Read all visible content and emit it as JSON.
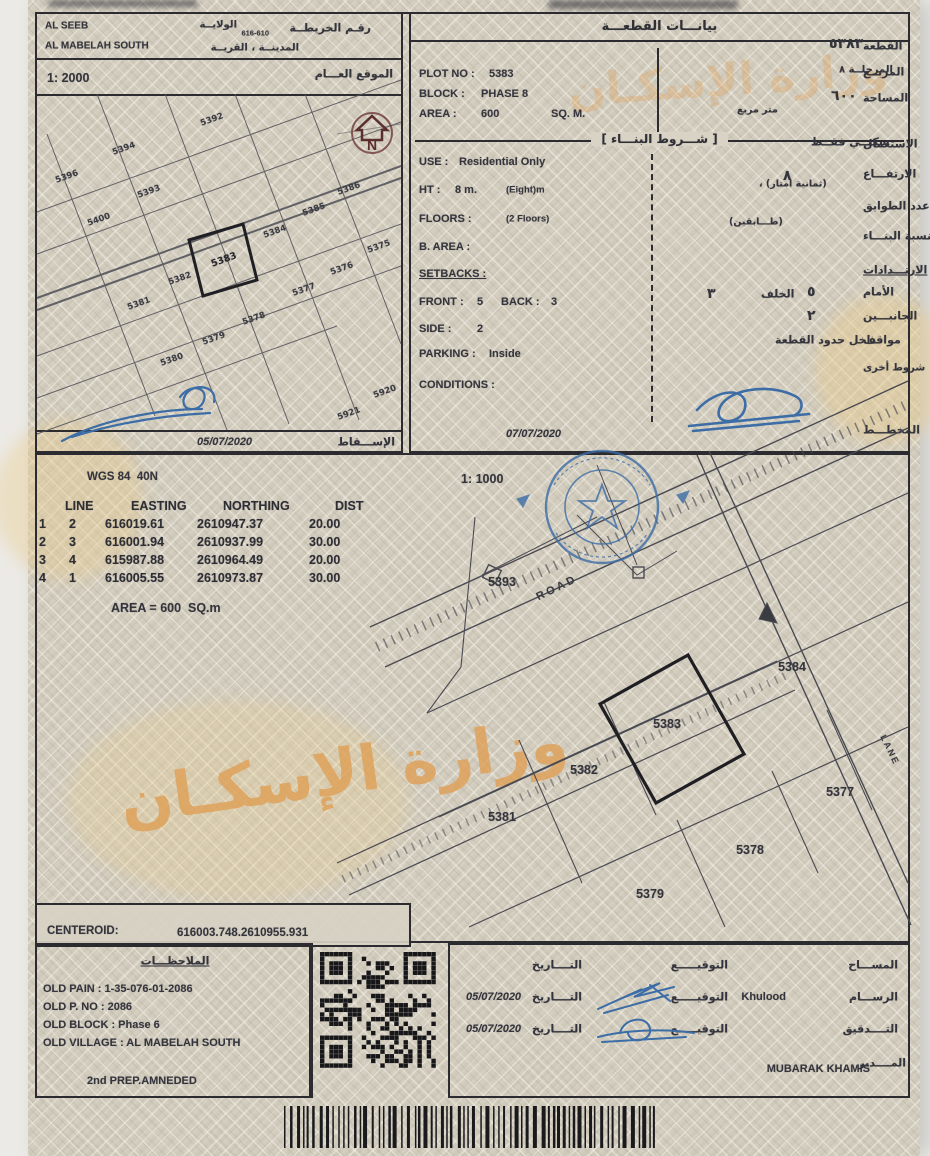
{
  "doc": {
    "top_left": {
      "scale": "1: 2000",
      "date": "05/07/2020",
      "north": "N",
      "header_items": [
        {
          "t": "AL SEEB",
          "x": 8,
          "y": 12,
          "c": "en s10"
        },
        {
          "t": "AL MABELAH SOUTH",
          "x": 8,
          "y": 32,
          "c": "en s10"
        },
        {
          "t": "رقـم الخريطــة",
          "x": 334,
          "y": 14,
          "a": "r"
        },
        {
          "t": "616-610",
          "x": 232,
          "y": 19,
          "a": "r",
          "c": "en tiny"
        },
        {
          "t": "الولايــة",
          "x": 200,
          "y": 11,
          "a": "r",
          "c": "sm2"
        },
        {
          "t": "المدينــة ، القريــة",
          "x": 262,
          "y": 34,
          "a": "r",
          "c": "sm2"
        },
        {
          "t": "1: 2000",
          "x": 10,
          "y": 64,
          "c": "en s12"
        },
        {
          "t": "الموقع العـــام",
          "x": 356,
          "y": 60,
          "a": "r"
        },
        {
          "t": "05/07/2020",
          "x": 160,
          "y": 428,
          "c": "en s11i"
        },
        {
          "t": "الإســـقاط",
          "x": 358,
          "y": 428,
          "a": "r"
        }
      ],
      "plots": [
        {
          "t": "5392",
          "x": 175,
          "y": 26
        },
        {
          "t": "5394",
          "x": 87,
          "y": 55
        },
        {
          "t": "5396",
          "x": 30,
          "y": 83
        },
        {
          "t": "5393",
          "x": 112,
          "y": 98
        },
        {
          "t": "5400",
          "x": 62,
          "y": 126
        },
        {
          "t": "5386",
          "x": 312,
          "y": 95
        },
        {
          "t": "5385",
          "x": 277,
          "y": 116
        },
        {
          "t": "5384",
          "x": 238,
          "y": 138
        },
        {
          "t": "5375",
          "x": 342,
          "y": 153
        },
        {
          "t": "5376",
          "x": 305,
          "y": 175
        },
        {
          "t": "5383",
          "x": 187,
          "y": 166,
          "c": "map mb"
        },
        {
          "t": "5382",
          "x": 143,
          "y": 185
        },
        {
          "t": "5377",
          "x": 267,
          "y": 196
        },
        {
          "t": "5381",
          "x": 102,
          "y": 210
        },
        {
          "t": "5378",
          "x": 217,
          "y": 225
        },
        {
          "t": "5379",
          "x": 177,
          "y": 245
        },
        {
          "t": "5380",
          "x": 135,
          "y": 266
        },
        {
          "t": "5920",
          "x": 348,
          "y": 298
        },
        {
          "t": "5921",
          "x": 312,
          "y": 320
        }
      ]
    },
    "plot_panel": {
      "title_ar": "بيانـــات القطعـــة",
      "conditions_header_ar": "[ شـــروط البنـــاء ]",
      "date": "07/07/2020",
      "en": [
        {
          "t": "PLOT NO :",
          "x": 8,
          "y": 60
        },
        {
          "t": "5383",
          "x": 78,
          "y": 60
        },
        {
          "t": "BLOCK :",
          "x": 8,
          "y": 80
        },
        {
          "t": "PHASE 8",
          "x": 70,
          "y": 80
        },
        {
          "t": "AREA :",
          "x": 8,
          "y": 100
        },
        {
          "t": "600",
          "x": 70,
          "y": 100
        },
        {
          "t": "SQ. M.",
          "x": 140,
          "y": 100
        },
        {
          "t": "USE :",
          "x": 8,
          "y": 148
        },
        {
          "t": "Residential Only",
          "x": 48,
          "y": 148
        },
        {
          "t": "HT :",
          "x": 8,
          "y": 176
        },
        {
          "t": "8 m.",
          "x": 44,
          "y": 176
        },
        {
          "t": "(Eight)m",
          "x": 95,
          "y": 176,
          "c": "en sm"
        },
        {
          "t": "FLOORS :",
          "x": 8,
          "y": 205
        },
        {
          "t": "(2 Floors)",
          "x": 95,
          "y": 205,
          "c": "en sm"
        },
        {
          "t": "B. AREA :",
          "x": 8,
          "y": 233
        },
        {
          "t": "SETBACKS :",
          "x": 8,
          "y": 260,
          "c": "en und"
        },
        {
          "t": "FRONT :",
          "x": 8,
          "y": 288
        },
        {
          "t": "5",
          "x": 66,
          "y": 288
        },
        {
          "t": "BACK :",
          "x": 90,
          "y": 288
        },
        {
          "t": "3",
          "x": 140,
          "y": 288
        },
        {
          "t": "SIDE :",
          "x": 8,
          "y": 315
        },
        {
          "t": "2",
          "x": 66,
          "y": 315
        },
        {
          "t": "PARKING :",
          "x": 8,
          "y": 340
        },
        {
          "t": "Inside",
          "x": 78,
          "y": 340
        },
        {
          "t": "CONDITIONS :",
          "x": 8,
          "y": 371
        },
        {
          "t": "07/07/2020",
          "x": 95,
          "y": 420,
          "c": "en s11i"
        }
      ],
      "ar": [
        {
          "t": "القطعة",
          "x": 452,
          "y": 32
        },
        {
          "t": "٥٣٨٣",
          "x": 418,
          "y": 30,
          "c": "big"
        },
        {
          "t": "المربــع",
          "x": 452,
          "y": 58
        },
        {
          "t": "المرحلــة ٨",
          "x": 428,
          "y": 56,
          "c": "sm2"
        },
        {
          "t": "المساحة",
          "x": 452,
          "y": 84
        },
        {
          "t": "٦٠٠",
          "x": 420,
          "y": 82,
          "c": "big"
        },
        {
          "t": "متر مربع",
          "x": 326,
          "y": 96,
          "c": "sm"
        },
        {
          "t": "الاستعمال",
          "x": 452,
          "y": 130
        },
        {
          "t": "سكنــي فقــط",
          "x": 400,
          "y": 128
        },
        {
          "t": "الارتفـــاع",
          "x": 452,
          "y": 160
        },
        {
          "t": "٨",
          "x": 372,
          "y": 162,
          "c": "big"
        },
        {
          "t": "، (ثمانية امتار)",
          "x": 348,
          "y": 170,
          "c": "sm"
        },
        {
          "t": "عدد الطوابق",
          "x": 452,
          "y": 192
        },
        {
          "t": "(طـــابقين)",
          "x": 318,
          "y": 208,
          "c": "sm"
        },
        {
          "t": "نسبة البنـــاء",
          "x": 452,
          "y": 222
        },
        {
          "t": "الارتـــدادات",
          "x": 452,
          "y": 256,
          "c": "und"
        },
        {
          "t": "الأمام",
          "x": 452,
          "y": 278
        },
        {
          "t": "٥",
          "x": 396,
          "y": 278,
          "c": "big"
        },
        {
          "t": "الخلف",
          "x": 350,
          "y": 280
        },
        {
          "t": "٣",
          "x": 296,
          "y": 280,
          "c": "big"
        },
        {
          "t": "الجانبـــين",
          "x": 452,
          "y": 302
        },
        {
          "t": "٢",
          "x": 396,
          "y": 302,
          "c": "big"
        },
        {
          "t": "مواقف",
          "x": 452,
          "y": 326
        },
        {
          "t": "داخل حدود القطعة",
          "x": 364,
          "y": 326
        },
        {
          "t": "شروط أخرى",
          "x": 452,
          "y": 354,
          "c": "sm2"
        },
        {
          "t": "المخطـــط",
          "x": 452,
          "y": 416
        }
      ]
    },
    "survey": {
      "datum": "WGS 84  40N",
      "scale": "1: 1000",
      "headers": [
        "LINE",
        "EASTING",
        "NORTHING",
        "DIST"
      ],
      "rows": [
        [
          "1",
          "2",
          "616019.61",
          "2610947.37",
          "20.00"
        ],
        [
          "2",
          "3",
          "616001.94",
          "2610937.99",
          "30.00"
        ],
        [
          "3",
          "4",
          "615987.88",
          "2610964.49",
          "20.00"
        ],
        [
          "4",
          "1",
          "616005.55",
          "2610973.87",
          "30.00"
        ]
      ],
      "area_note": "AREA = 600  SQ.m",
      "labels": [
        {
          "t": "5393",
          "x": 465,
          "y": 127
        },
        {
          "t": "ROAD",
          "x": 520,
          "y": 133,
          "r": -26,
          "c": "road"
        },
        {
          "t": "5384",
          "x": 755,
          "y": 212
        },
        {
          "t": "5383",
          "x": 630,
          "y": 269
        },
        {
          "t": "5382",
          "x": 547,
          "y": 315
        },
        {
          "t": "5381",
          "x": 465,
          "y": 362
        },
        {
          "t": "5377",
          "x": 803,
          "y": 337
        },
        {
          "t": "5378",
          "x": 713,
          "y": 395
        },
        {
          "t": "5379",
          "x": 613,
          "y": 439
        },
        {
          "t": "LANE",
          "x": 853,
          "y": 295,
          "r": 64,
          "c": "road lane"
        }
      ],
      "centeroid_label": "CENTEROID:",
      "centeroid_value": "616003.748.2610955.931",
      "watermark_ar": "وزارة الإسكـان"
    },
    "notes": {
      "items": [
        {
          "t": "الملاحظـــات",
          "x": 138,
          "y": 16,
          "a": "c",
          "c": "und"
        },
        {
          "t": "OLD PAIN : 1-35-076-01-2086",
          "x": 6,
          "y": 44,
          "c": "en s11"
        },
        {
          "t": "OLD P. NO : 2086",
          "x": 6,
          "y": 62,
          "c": "en s11"
        },
        {
          "t": "OLD BLOCK : Phase 6",
          "x": 6,
          "y": 80,
          "c": "en s11"
        },
        {
          "t": "OLD VILLAGE : AL MABELAH SOUTH",
          "x": 6,
          "y": 98,
          "c": "en s11"
        },
        {
          "t": "2nd PREP.AMNEDED",
          "x": 50,
          "y": 136,
          "c": "en s11"
        }
      ]
    },
    "sign": {
      "items": [
        {
          "t": "المســـاح",
          "x": 448,
          "y": 20,
          "a": "r"
        },
        {
          "t": "التوقيـــــع",
          "x": 278,
          "y": 20,
          "a": "r"
        },
        {
          "t": "التــــاريخ",
          "x": 132,
          "y": 20,
          "a": "r"
        },
        {
          "t": "الرســـام",
          "x": 448,
          "y": 52,
          "a": "r"
        },
        {
          "t": "Khulood",
          "x": 336,
          "y": 52,
          "a": "r",
          "c": "en"
        },
        {
          "t": "التوقيـــــع",
          "x": 278,
          "y": 52,
          "a": "r"
        },
        {
          "t": "التــــاريخ",
          "x": 132,
          "y": 52,
          "a": "r"
        },
        {
          "t": "05/07/2020",
          "x": 16,
          "y": 52,
          "c": "en s11i"
        },
        {
          "t": "التــــدقيق",
          "x": 448,
          "y": 84,
          "a": "r"
        },
        {
          "t": "التوقيـــــع",
          "x": 278,
          "y": 84,
          "a": "r"
        },
        {
          "t": "التــــاريخ",
          "x": 132,
          "y": 84,
          "a": "r"
        },
        {
          "t": "05/07/2020",
          "x": 16,
          "y": 84,
          "c": "en s11i"
        },
        {
          "t": "المــــدير",
          "x": 456,
          "y": 118,
          "a": "r"
        },
        {
          "t": "MUBARAK KHAMIS",
          "x": 420,
          "y": 124,
          "a": "r",
          "c": "en b"
        }
      ]
    },
    "colors": {
      "paper": "#d7d1c3",
      "ink": "#2b2b30",
      "stamp_blue": "#3c6da6",
      "watermark_orange": "#df9f55"
    }
  }
}
